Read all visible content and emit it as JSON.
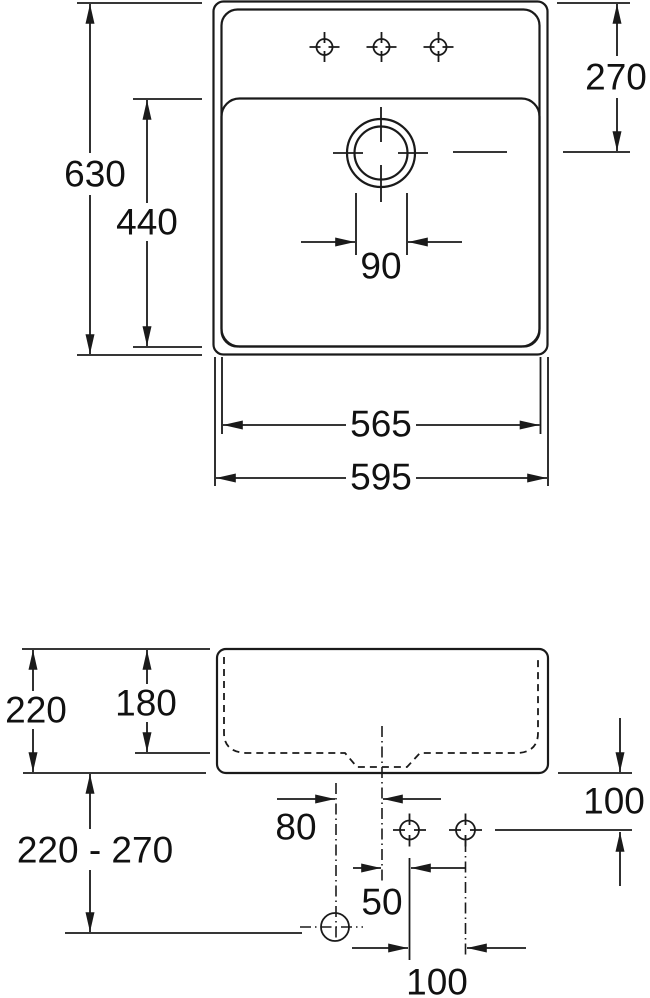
{
  "meta": {
    "drawing_type": "sink technical dimension drawing",
    "line_color": "#1a1a1a",
    "background_color": "#ffffff"
  },
  "top_view": {
    "name": "plan view",
    "dims": {
      "overall_height": "630",
      "inner_basin_height": "440",
      "top_edge_to_drain_center": "270",
      "drain_hole_diameter": "90",
      "inner_basin_width": "565",
      "overall_width": "595"
    }
  },
  "side_view": {
    "name": "side elevation",
    "dims": {
      "overall_depth": "220",
      "basin_inner_depth": "180",
      "waste_outlet_height_range": "220 - 270",
      "wall_outlet_offset": "80",
      "holes_below_bottom": "100",
      "center_to_first_hole": "50",
      "hole_spacing": "100"
    }
  }
}
